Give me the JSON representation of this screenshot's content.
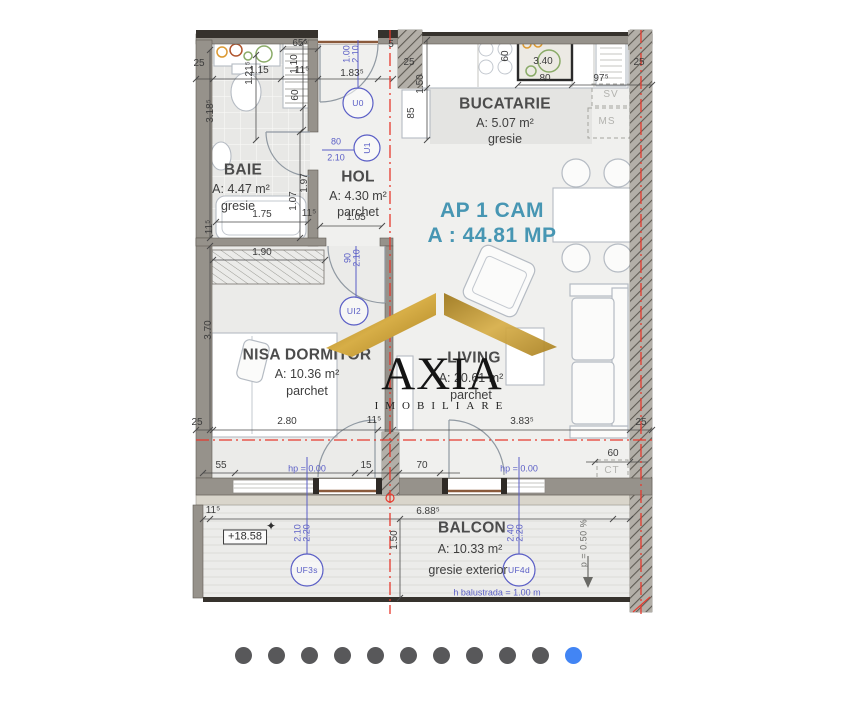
{
  "plan": {
    "title": {
      "line1": "AP 1 CAM",
      "line2": "A : 44.81 MP"
    },
    "rooms": [
      {
        "name": "BAIE",
        "area": "A: 4.47 m²",
        "floor": "gresie",
        "nx": 243,
        "ny": 170,
        "ax": 241,
        "ay": 189,
        "fx": 238,
        "fy": 206
      },
      {
        "name": "HOL",
        "area": "A: 4.30 m²",
        "floor": "parchet",
        "nx": 358,
        "ny": 177,
        "ax": 358,
        "ay": 196,
        "fx": 358,
        "fy": 212
      },
      {
        "name": "BUCATARIE",
        "area": "A: 5.07 m²",
        "floor": "gresie",
        "nx": 505,
        "ny": 104,
        "ax": 505,
        "ay": 123,
        "fx": 505,
        "fy": 139
      },
      {
        "name": "NISA DORMITOR",
        "area": "A: 10.36 m²",
        "floor": "parchet",
        "nx": 307,
        "ny": 355,
        "ax": 307,
        "ay": 374,
        "fx": 307,
        "fy": 391
      },
      {
        "name": "LIVING",
        "area": "A: 20.61 m²",
        "floor": "parchet",
        "nx": 474,
        "ny": 358,
        "ax": 471,
        "ay": 378,
        "fx": 471,
        "fy": 395
      },
      {
        "name": "BALCON",
        "area": "A: 10.33 m²",
        "floor": "gresie exterior",
        "nx": 472,
        "ny": 528,
        "ax": 470,
        "ay": 549,
        "fx": 468,
        "fy": 570
      }
    ],
    "labels": [
      {
        "t": "25",
        "x": 199,
        "y": 64
      },
      {
        "t": "1.15",
        "x": 259,
        "y": 71
      },
      {
        "t": "11⁵",
        "x": 302,
        "y": 71
      },
      {
        "t": "1.21⁵",
        "x": 250,
        "y": 73,
        "r": -90
      },
      {
        "t": "65⁵",
        "x": 300,
        "y": 44
      },
      {
        "t": "1.10",
        "x": 295,
        "y": 64,
        "r": -90
      },
      {
        "t": "60",
        "x": 296,
        "y": 95,
        "r": -90
      },
      {
        "t": "1.83⁵",
        "x": 352,
        "y": 74
      },
      {
        "t": "5",
        "x": 391,
        "y": 45
      },
      {
        "t": "25",
        "x": 409,
        "y": 63
      },
      {
        "t": "1.50",
        "x": 421,
        "y": 84,
        "r": -90
      },
      {
        "t": "85",
        "x": 412,
        "y": 113,
        "r": -90
      },
      {
        "t": "60",
        "x": 506,
        "y": 56,
        "r": -90
      },
      {
        "t": "3.40",
        "x": 543,
        "y": 62
      },
      {
        "t": "80",
        "x": 545,
        "y": 79
      },
      {
        "t": "97⁵",
        "x": 601,
        "y": 79
      },
      {
        "t": "25",
        "x": 639,
        "y": 63
      },
      {
        "t": "3.18⁵",
        "x": 211,
        "y": 111,
        "r": -90
      },
      {
        "t": "1.75",
        "x": 262,
        "y": 215
      },
      {
        "t": "1.97",
        "x": 305,
        "y": 183,
        "r": -90
      },
      {
        "t": "1.07",
        "x": 294,
        "y": 201,
        "r": -90
      },
      {
        "t": "11⁵",
        "x": 309,
        "y": 214
      },
      {
        "t": "11⁵",
        "x": 210,
        "y": 227,
        "r": -90
      },
      {
        "t": "1.05",
        "x": 356,
        "y": 218
      },
      {
        "t": "1.90",
        "x": 262,
        "y": 253
      },
      {
        "t": "3.70",
        "x": 209,
        "y": 330,
        "r": -90
      },
      {
        "t": "2.80",
        "x": 287,
        "y": 422
      },
      {
        "t": "11⁵",
        "x": 374,
        "y": 421
      },
      {
        "t": "3.83⁵",
        "x": 522,
        "y": 422
      },
      {
        "t": "25",
        "x": 197,
        "y": 423
      },
      {
        "t": "25",
        "x": 641,
        "y": 423
      },
      {
        "t": "55",
        "x": 221,
        "y": 466
      },
      {
        "t": "15",
        "x": 366,
        "y": 466
      },
      {
        "t": "70",
        "x": 422,
        "y": 466
      },
      {
        "t": "60",
        "x": 613,
        "y": 454
      },
      {
        "t": "11⁵",
        "x": 213,
        "y": 511
      },
      {
        "t": "6.88⁵",
        "x": 428,
        "y": 512
      },
      {
        "t": "1.50",
        "x": 395,
        "y": 540,
        "r": -90
      },
      {
        "t": "✦",
        "x": 271,
        "y": 526,
        "c": "star"
      },
      {
        "t": "p = 0.50 %",
        "x": 584,
        "y": 543,
        "r": -90,
        "c": "dims"
      },
      {
        "t": "SV",
        "x": 611,
        "y": 95,
        "c": "appl"
      },
      {
        "t": "MS",
        "x": 607,
        "y": 122,
        "c": "appl"
      },
      {
        "t": "CT",
        "x": 612,
        "y": 471,
        "c": "appl"
      },
      {
        "t": "+18.58",
        "x": 245,
        "y": 537,
        "c": "elev"
      },
      {
        "t": "1.00",
        "x": 347,
        "y": 54,
        "r": -90,
        "c": "blue"
      },
      {
        "t": "2.10",
        "x": 356,
        "y": 54,
        "r": -90,
        "c": "blue"
      },
      {
        "t": "80",
        "x": 336,
        "y": 142,
        "c": "blue"
      },
      {
        "t": "2.10",
        "x": 336,
        "y": 158,
        "c": "blue"
      },
      {
        "t": "90",
        "x": 348,
        "y": 258,
        "r": -90,
        "c": "blue"
      },
      {
        "t": "2.10",
        "x": 357,
        "y": 258,
        "r": -90,
        "c": "blue"
      },
      {
        "t": "hp = 0.00",
        "x": 307,
        "y": 469,
        "c": "blue"
      },
      {
        "t": "hp = 0.00",
        "x": 519,
        "y": 469,
        "c": "blue"
      },
      {
        "t": "2.10",
        "x": 298,
        "y": 533,
        "r": -90,
        "c": "blue"
      },
      {
        "t": "2.20",
        "x": 307,
        "y": 533,
        "r": -90,
        "c": "blue"
      },
      {
        "t": "2.40",
        "x": 511,
        "y": 533,
        "r": -90,
        "c": "blue"
      },
      {
        "t": "2.20",
        "x": 520,
        "y": 533,
        "r": -90,
        "c": "blue"
      },
      {
        "t": "h balustrada = 1.00 m",
        "x": 497,
        "y": 593,
        "c": "blue"
      },
      {
        "t": "U0",
        "x": 358,
        "y": 103,
        "c": "tag"
      },
      {
        "t": "U1",
        "x": 367,
        "y": 148,
        "r": -90,
        "c": "tag"
      },
      {
        "t": "UI2",
        "x": 354,
        "y": 311,
        "c": "tag"
      },
      {
        "t": "UF3s",
        "x": 307,
        "y": 570,
        "c": "tag"
      },
      {
        "t": "UF4d",
        "x": 519,
        "y": 570,
        "c": "tag"
      }
    ]
  },
  "watermark": {
    "name": "AXIA",
    "subtitle": "IMOBILIARE"
  },
  "carousel": {
    "dot_count": 11,
    "active_index": 10
  },
  "colors": {
    "teal": "#4796b3",
    "annotation_blue": "#5a5ec6",
    "axis_red": "#e63a2e",
    "gold_dark": "#9c7518",
    "gold_light": "#d7ae47",
    "dot": "#58585a",
    "dot_active": "#4285f4"
  }
}
